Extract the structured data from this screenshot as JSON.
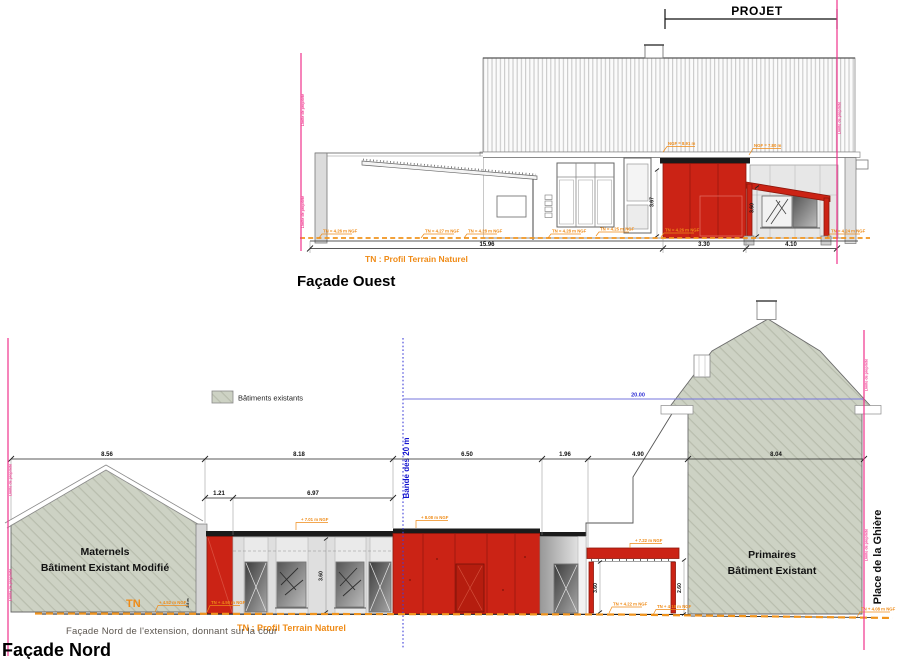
{
  "common": {
    "limite": "Limite de propriété"
  },
  "ouest": {
    "title": "Façade Ouest",
    "projet": "PROJET",
    "dim_total": "15.96",
    "dim_red": "3.30",
    "dim_porch": "4.10",
    "h_red": "3.67",
    "h_porch": "3.60",
    "ngf_red": "NGF = 8.91 m",
    "ngf_porch": "NGF = 7.80 m",
    "tn_line": "TN : Profil Terrain Naturel",
    "ground": [
      "TN = 4.26 m NGF",
      "TN = 4.27 m NGF",
      "TN = 4.28 m NGF",
      "TN = 4.28 m NGF",
      "TN = 4.25 m NGF",
      "TN = 4.26 m NGF",
      "TN = 4.24 m NGF"
    ]
  },
  "nord": {
    "title": "Façade Nord",
    "caption": "Façade Nord de l'extension, donnant sur la cour",
    "maternels1": "Maternels",
    "maternels2": "Bâtiment Existant Modifié",
    "primaires1": "Primaires",
    "primaires2": "Bâtiment Existant",
    "legend": "Bâtiments existants",
    "bande": "Bande des 20 m",
    "place": "Place de la Ghière",
    "tn": "TN",
    "tn_line": "TN : Profil Terrain Naturel",
    "band_height": "20.00",
    "dims1": [
      "8.56",
      "8.18",
      "6.50",
      "1.96",
      "4.90",
      "8.04"
    ],
    "dims2": [
      "1.21",
      "6.97"
    ],
    "h_mid": "3.60",
    "h_canopy": "3.60",
    "h_passage": "2.60",
    "h_small": "2.8 m",
    "ngf_mid": "+ 7.01 m NGF",
    "ngf_red": "+ 8.08 m NGF",
    "ngf_canopy": "+ 7.22 m NGF",
    "ground": [
      "+ 4.52 m NGF",
      "TN + 4.50 m NGF",
      "TN + 4.22 m NGF",
      "TN + 4.18 m NGF",
      "TN + 4.08 m NGF"
    ]
  },
  "colors": {
    "red": "#cb2315",
    "sage": "#cdd2c4",
    "pink": "#f0338d",
    "orange": "#ef8b17",
    "blue": "#2525d8"
  }
}
